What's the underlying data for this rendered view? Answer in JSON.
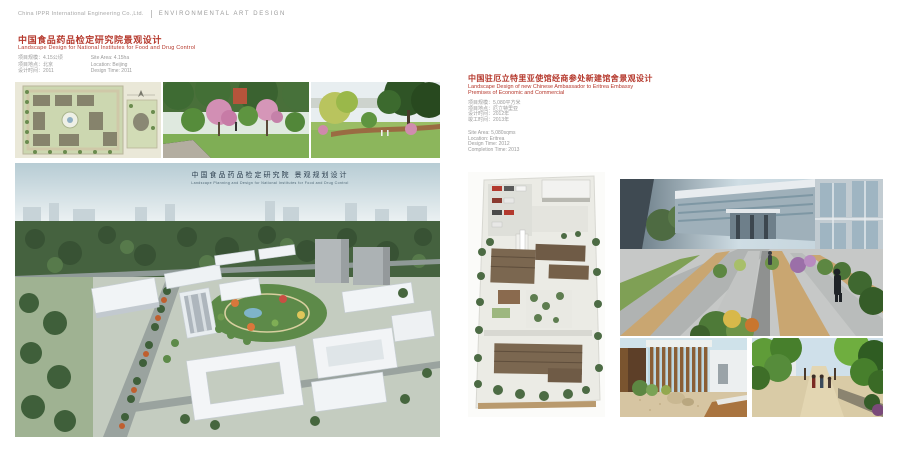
{
  "header": {
    "company": "China IPPR International Engineering Co.,Ltd.",
    "section": "ENVIRONMENTAL ART DESIGN"
  },
  "left_project": {
    "title_cn": "中国食品药品检定研究院景观设计",
    "title_en": "Landscape Design for National Institutes for Food and Drug Control",
    "meta_cn": [
      "项目规模：4.15公顷",
      "项目地点：北京",
      "设计时间：2011"
    ],
    "meta_en": [
      "Site Area: 4.15ha",
      "Location: Beijing",
      "Design Time: 2011"
    ],
    "watermark_cn": "中国食品药品检定研究院 景观规划设计",
    "watermark_en": "Landscape Planning and Design for National Institutes for Food and Drug Control"
  },
  "right_project": {
    "title_cn": "中国驻厄立特里亚使馆经商参处新建馆舍景观设计",
    "title_en_1": "Landscape Design of new Chinese Ambassador to Eritrea Embassy",
    "title_en_2": "Premises of Economic and Commercial",
    "meta_cn": [
      "项目规模：5,080平方米",
      "项目地点：厄立特里亚",
      "设计时间：2012年",
      "竣工时间：2013年"
    ],
    "meta_en": [
      "Site Area: 5,080sqms",
      "Location: Eritrea",
      "Design Time: 2012",
      "Completion Time: 2013"
    ]
  },
  "colors": {
    "accent_red": "#b5382c"
  }
}
